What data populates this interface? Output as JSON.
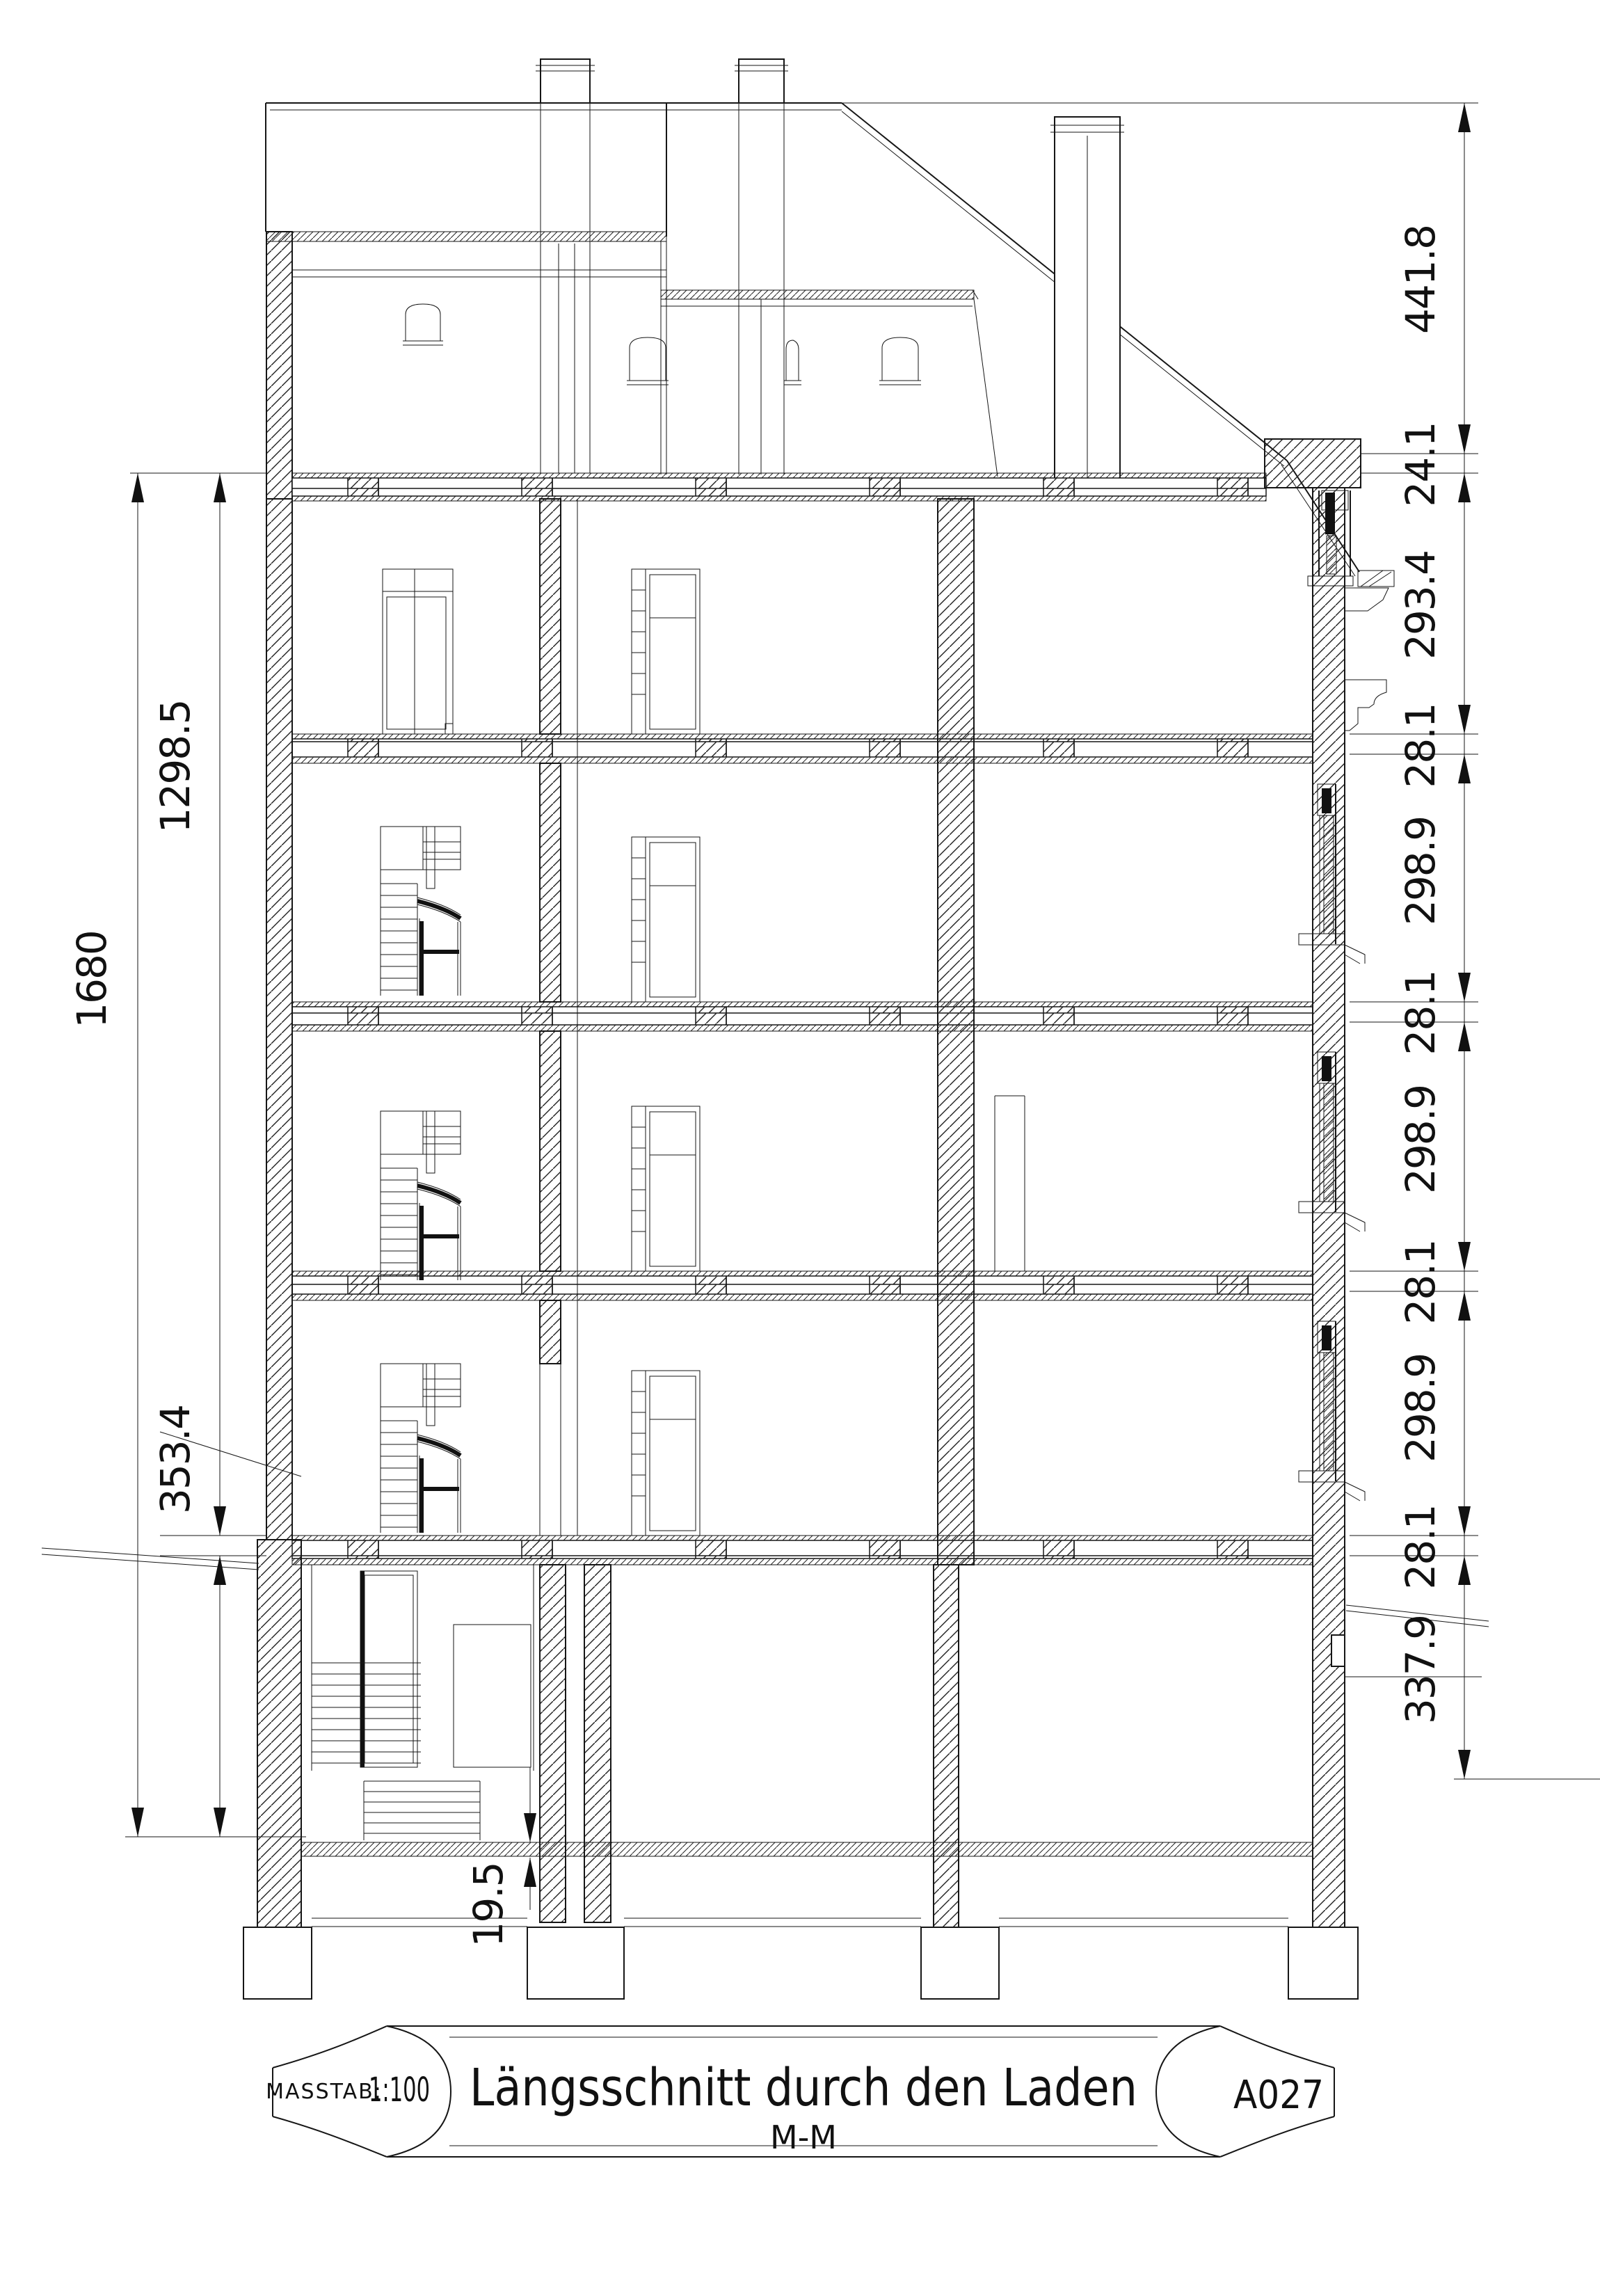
{
  "title_block": {
    "scale_label": "MASSTAB:",
    "scale_value": "1:100",
    "title": "Längsschnitt durch den Laden",
    "section_mark": "M-M",
    "sheet_number": "A027"
  },
  "dimensions": {
    "right_chain": [
      "441.8",
      "24.1",
      "293.4",
      "28.1",
      "298.9",
      "28.1",
      "298.9",
      "28.1",
      "298.9",
      "28.1",
      "337.9"
    ],
    "left_chain": {
      "total": "1680",
      "upper": "1298.5",
      "ground": "353.4",
      "slab": "19.5"
    }
  }
}
